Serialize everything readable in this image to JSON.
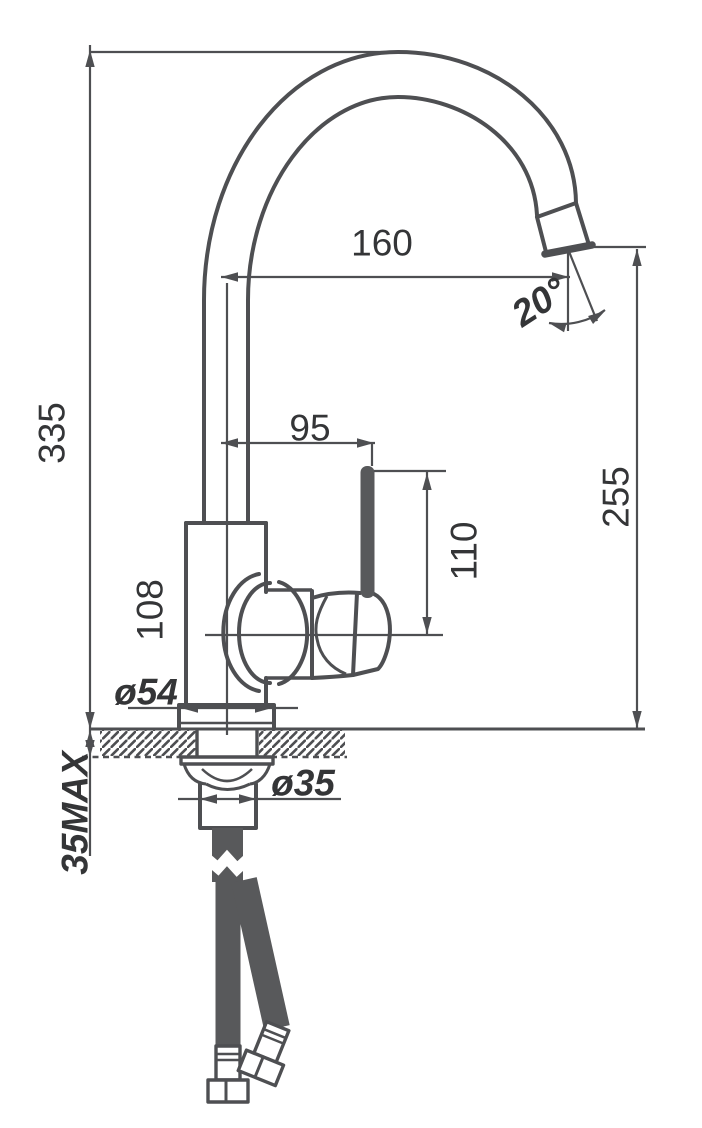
{
  "drawing": {
    "type": "faucet-dimensional-diagram",
    "dimensions": {
      "overall_height": "335",
      "spout_reach": "160",
      "spout_outlet_height": "255",
      "handle_offset": "95",
      "handle_height": "110",
      "body_height": "108",
      "base_diameter": "ø54",
      "shank_diameter": "ø35",
      "countertop_max_thickness": "35MAX",
      "outlet_angle": "20°"
    },
    "colors": {
      "line": "#4e4f52",
      "text": "#343537",
      "fill": "#58595b",
      "background": "#ffffff"
    }
  }
}
